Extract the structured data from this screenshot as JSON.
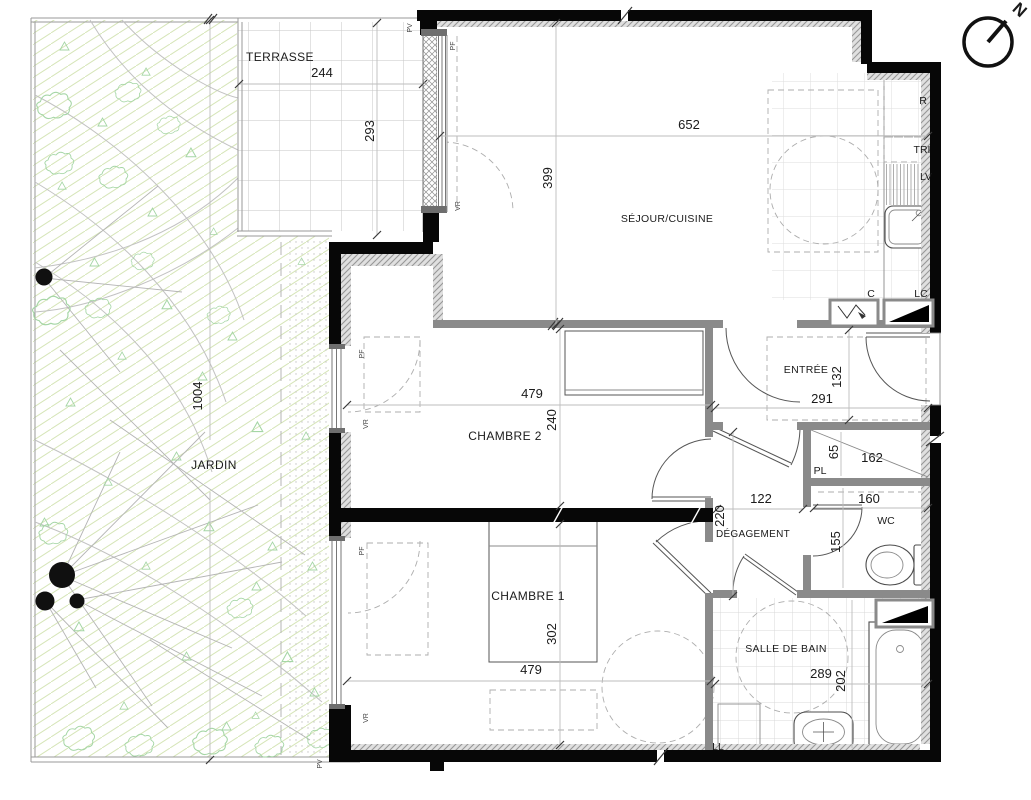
{
  "rooms": {
    "jardin": {
      "label": "JARDIN",
      "depth": "1004"
    },
    "terrasse": {
      "label": "TERRASSE",
      "width": "244",
      "depth": "293"
    },
    "sejour_cuisine": {
      "label": "SÉJOUR/CUISINE",
      "width": "652",
      "depth": "399"
    },
    "chambre2": {
      "label": "CHAMBRE 2",
      "width": "479",
      "depth": "240"
    },
    "chambre1": {
      "label": "CHAMBRE 1",
      "width": "479",
      "depth": "302"
    },
    "entree": {
      "label": "ENTRÉE",
      "width": "291",
      "depth": "132"
    },
    "degagement": {
      "label": "DÉGAGEMENT",
      "width": "122",
      "depth": "220"
    },
    "placard": {
      "label": "PL",
      "width": "162",
      "depth": "65"
    },
    "wc": {
      "label": "WC",
      "width": "160",
      "depth": "155"
    },
    "salle_de_bain": {
      "label": "SALLE DE BAIN",
      "width": "289",
      "depth": "202"
    }
  },
  "equipment": {
    "refrigerateur": "R",
    "tri": "TRI",
    "lave_vaisselle": "LV",
    "chauffe_eau": "C",
    "lave_linge_colonne": "LC",
    "lave_linge": "LL"
  },
  "openings": {
    "porte_fenetre": "PF",
    "volet_roulant": "VR",
    "porte_vitree": "PV"
  },
  "compass": {
    "north": "N"
  }
}
